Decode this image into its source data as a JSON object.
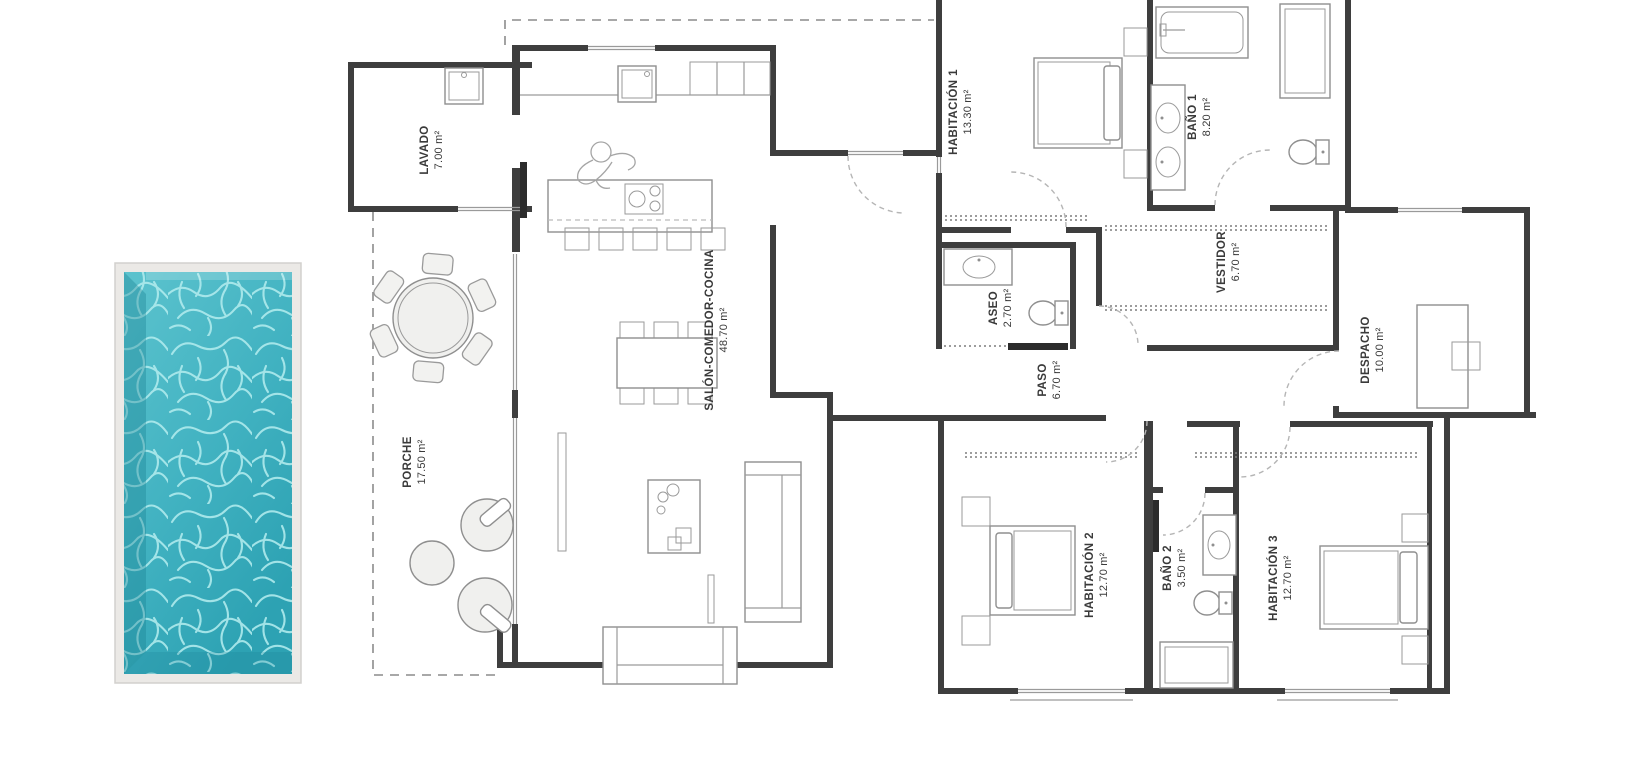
{
  "plan": {
    "title": "villa-floor-plan",
    "rooms": [
      {
        "id": "lavado",
        "name": "LAVADO",
        "area": "7.00 m²"
      },
      {
        "id": "salon",
        "name": "SALÓN-COMEDOR-COCINA",
        "area": "48.70 m²"
      },
      {
        "id": "porche",
        "name": "PORCHE",
        "area": "17.50 m²"
      },
      {
        "id": "habitacion1",
        "name": "HABITACIÓN 1",
        "area": "13.30 m²"
      },
      {
        "id": "bano1",
        "name": "BAÑO 1",
        "area": "8.20 m²"
      },
      {
        "id": "aseo",
        "name": "ASEO",
        "area": "2.70 m²"
      },
      {
        "id": "vestidor",
        "name": "VESTIDOR",
        "area": "6.70 m²"
      },
      {
        "id": "paso",
        "name": "PASO",
        "area": "6.70 m²"
      },
      {
        "id": "despacho",
        "name": "DESPACHO",
        "area": "10.00 m²"
      },
      {
        "id": "habitacion2",
        "name": "HABITACIÓN 2",
        "area": "12.70 m²"
      },
      {
        "id": "bano2",
        "name": "BAÑO 2",
        "area": "3.50 m²"
      },
      {
        "id": "habitacion3",
        "name": "HABITACIÓN 3",
        "area": "12.70 m²"
      }
    ],
    "colors": {
      "wall": "#3e3e3e",
      "furniture_line": "#8f8f8f",
      "pool_water": "#41b2c1",
      "pool_water_light": "#aeeaec",
      "pool_frame": "#ebe9e6",
      "background": "#ffffff",
      "label_text": "#3a3a3a"
    }
  }
}
